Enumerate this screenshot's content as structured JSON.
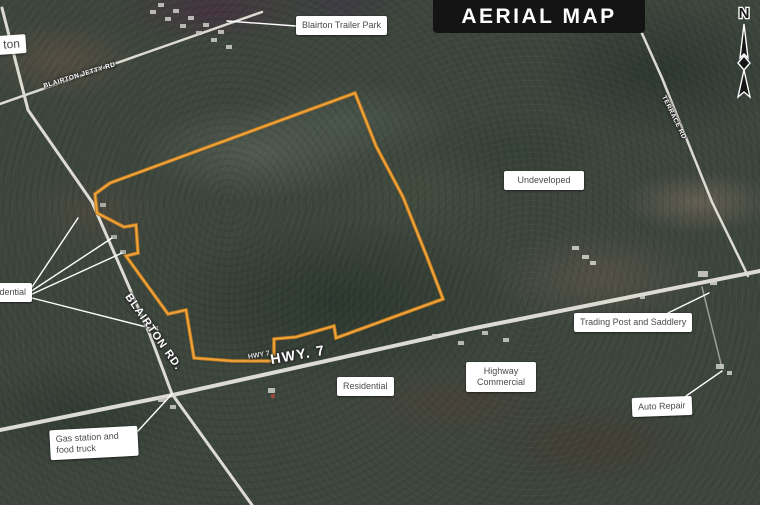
{
  "title": "AERIAL MAP",
  "compass": {
    "north_label": "N"
  },
  "area_labels": {
    "blairton_partial": "ton",
    "blairton_trailer_park": "Blairton Trailer Park",
    "undeveloped": "Undeveloped",
    "trading_post_and_saddlery": "Trading Post and Saddlery",
    "highway_commercial": "Highway Commercial",
    "residential": "Residential",
    "residential_partial": "dential",
    "auto_repair": "Auto Repair",
    "gas_station": "Gas station and food truck"
  },
  "road_labels": {
    "hwy7": "HWY. 7",
    "hwy7_small": "HWY 7",
    "blairton_rd": "BLAIRTON RD.",
    "blairton_jetty_rd": "BLAIRTON JETTY RD",
    "terrace_rd": "TERRACE RD"
  },
  "colors": {
    "boundary_orange": "#f2a33c",
    "title_bg": "#141414",
    "title_text": "#ffffff",
    "label_bg": "#ffffff",
    "label_text": "#4a4a4a",
    "road_color": "#e6e4dc"
  }
}
